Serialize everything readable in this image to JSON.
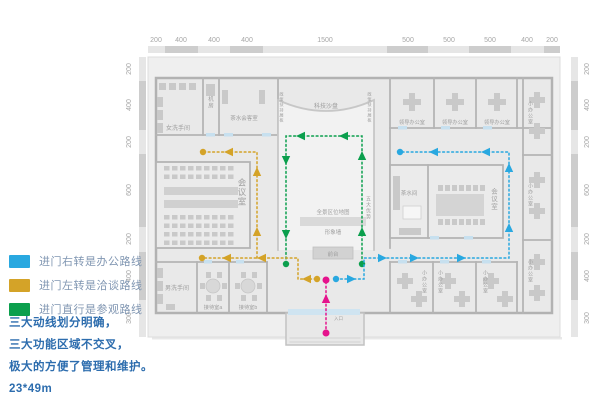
{
  "colors": {
    "office_blue": "#29a8e0",
    "talk_gold": "#d4a328",
    "visit_green": "#0b9f4d",
    "entrance_pink": "#e5138d"
  },
  "rulers": {
    "top": [
      "200",
      "400",
      "400",
      "400",
      "1500",
      "500",
      "500",
      "500",
      "400",
      "200"
    ],
    "left": [
      "200",
      "400",
      "200",
      "600",
      "200",
      "400",
      "300"
    ],
    "right": [
      "200",
      "400",
      "200",
      "600",
      "200",
      "400",
      "300"
    ]
  },
  "plan": {
    "rooms": {
      "women_wc": "女洗手间",
      "machine_room": "机房",
      "tea_meeting": "茶水会客室",
      "tech_sandtable": "科技沙盘",
      "policy_wall": "政策扶持展板",
      "five_advantages": "五大优势",
      "panorama_map": "全景区位地图",
      "image_wall": "形象墙",
      "front_desk": "前台",
      "meeting_room": "会议室",
      "tea_room": "茶水间",
      "leader_office": "领导办公室",
      "small_office": "小办公室",
      "men_wc": "男洗手间",
      "reception_a": "接待室a",
      "reception_b": "接待室b",
      "entrance": "入口"
    }
  },
  "legend": {
    "items": [
      {
        "color": "#29a8e0",
        "label": "进门右转是办公路线"
      },
      {
        "color": "#d4a328",
        "label": "进门左转是洽谈路线"
      },
      {
        "color": "#0b9f4d",
        "label": "进门直行是参观路线"
      }
    ]
  },
  "caption": {
    "lines": [
      "三大动线划分明确，",
      "三大功能区域不交叉，",
      "极大的方便了管理和维护。"
    ],
    "size": "23*49m"
  }
}
